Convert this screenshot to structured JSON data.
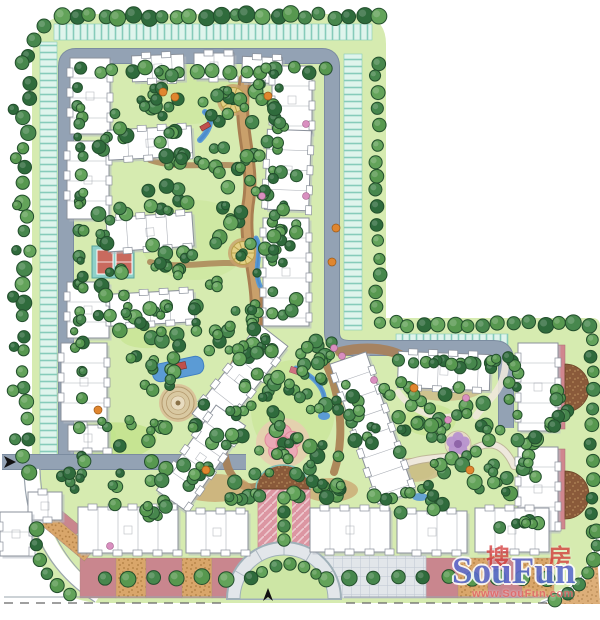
{
  "watermark": {
    "cn_left": "搜",
    "cn_right": "房",
    "latin": "SouFun",
    "url": "www.SouFun.com"
  },
  "colors": {
    "paper": "#ffffff",
    "site_green": "#d6ebb0",
    "lawn": "#c6e492",
    "lawn_bright": "#c2e48e",
    "tree_dark": "#2f6b3c",
    "tree_mid": "#47874d",
    "tree_light": "#63a35a",
    "tree_extra": "#57984f",
    "tree_stroke": "#234f2d",
    "hedge_band": "#dff4ec",
    "hedge_line": "#86cbba",
    "road": "#93a2b4",
    "road_edge": "#7b8ca0",
    "path_brown": "#a97e52",
    "path_light": "#c9a06b",
    "building_fill": "#ffffff",
    "building_stroke": "#8b919b",
    "building_shadow": "#b7bcc4",
    "water": "#5b9bd5",
    "water_deep": "#3f7ec2",
    "court_red": "#c96a5e",
    "court_teal": "#8fd0c8",
    "plaza_pink": "#eba9b6",
    "plaza_pink_deep": "#e18a9a",
    "amphitheater": "#8a5a3a",
    "paving_rose": "#c9868e",
    "paving_tan": "#d9a66a",
    "cobble": "#e2e6ea",
    "entry_pink": "#dc96a2",
    "flower_purple": "#b792cf",
    "flower_purple_deep": "#8f65a8",
    "accent_orange": "#e0862f",
    "accent_pink": "#d98fc0",
    "target_tan": "#d9c9a2",
    "node_yellow": "#e3d084",
    "node_ring": "#b89f4a",
    "bridge_red": "#c0504d",
    "bridge_pink": "#d07080",
    "outline": "#9aa4ae",
    "dash_line": "#666666",
    "marker_black": "#111111",
    "wm_red": "#d43c3c",
    "wm_blue": "#5b6bd0",
    "wm_url": "#e46a6a"
  }
}
